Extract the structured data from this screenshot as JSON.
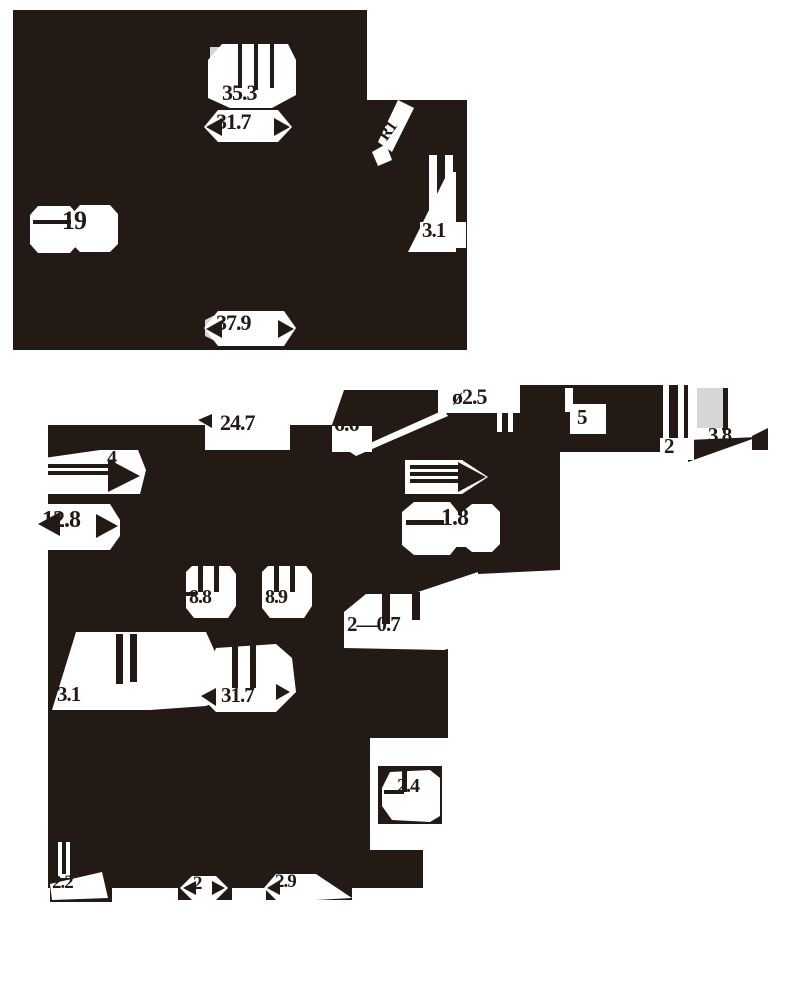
{
  "drawing": {
    "kind": "engineering dimension drawing, two views",
    "colors": {
      "ink": "#241a15",
      "paper": "#ffffff",
      "gray": "#d8d6d4"
    },
    "dims": {
      "v1_35_3": "35.3",
      "v1_31_7": "31.7",
      "v1_r1": "R1",
      "v1_19": "19",
      "v1_3_1": "3.1",
      "v1_37_9": "37.9",
      "v2_24_7": "24.7",
      "v2_6_6": "6.6",
      "v2_dia_2_5": "ø2.5",
      "v2_5": "5",
      "v2_2_top": "2",
      "v2_3_8": "3.8",
      "v2_4": "4",
      "v2_12_8": "12.8",
      "v2_1_8": "1.8",
      "v2_8_8": "8.8",
      "v2_8_9": "8.9",
      "v2_2x0_7": "2—0.7",
      "v2_3_1": "3.1",
      "v2_31_7": "31.7",
      "v2_2_4": "2.4",
      "v2_2_2": "2.2",
      "v2_2_bottom": "2",
      "v2_2_9": "2.9"
    }
  }
}
